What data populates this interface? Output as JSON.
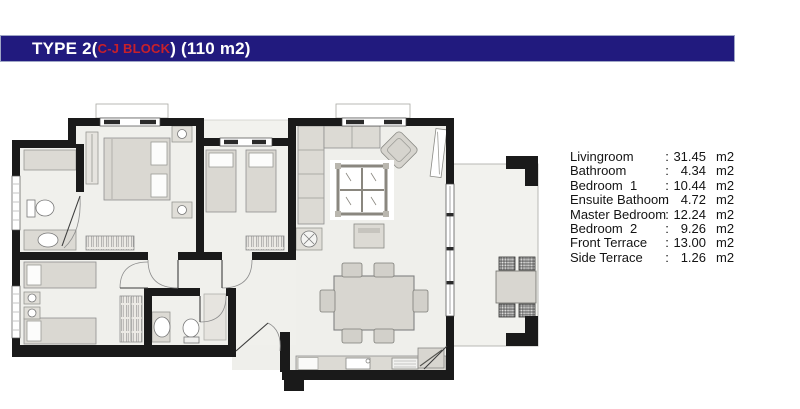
{
  "header": {
    "title_prefix": "TYPE 2(",
    "block_label": "C-J BLOCK",
    "title_suffix": ") (110 m2)"
  },
  "legend": {
    "separator": ":",
    "rows": [
      {
        "label": "Livingroom",
        "value": "31.45",
        "unit": "m2"
      },
      {
        "label": "Bathroom",
        "value": "4.34",
        "unit": "m2"
      },
      {
        "label": "Bedroom  1",
        "value": "10.44",
        "unit": "m2"
      },
      {
        "label": "Ensuite Bathoom",
        "value": "4.72",
        "unit": "m2"
      },
      {
        "label": "Master Bedroom",
        "value": "12.24",
        "unit": "m2"
      },
      {
        "label": "Bedroom  2",
        "value": "9.26",
        "unit": "m2"
      },
      {
        "label": "Front Terrace",
        "value": "13.00",
        "unit": "m2"
      },
      {
        "label": "Side Terrace",
        "value": "1.26",
        "unit": "m2"
      }
    ]
  },
  "colors": {
    "header_bg": "#211a7e",
    "header_border": "#9fa6c6",
    "title_text": "#ffffff",
    "block_text": "#c8202a",
    "wall": "#1a1a1a",
    "floor": "#f0f0ec",
    "furniture": "#dcdad4"
  }
}
